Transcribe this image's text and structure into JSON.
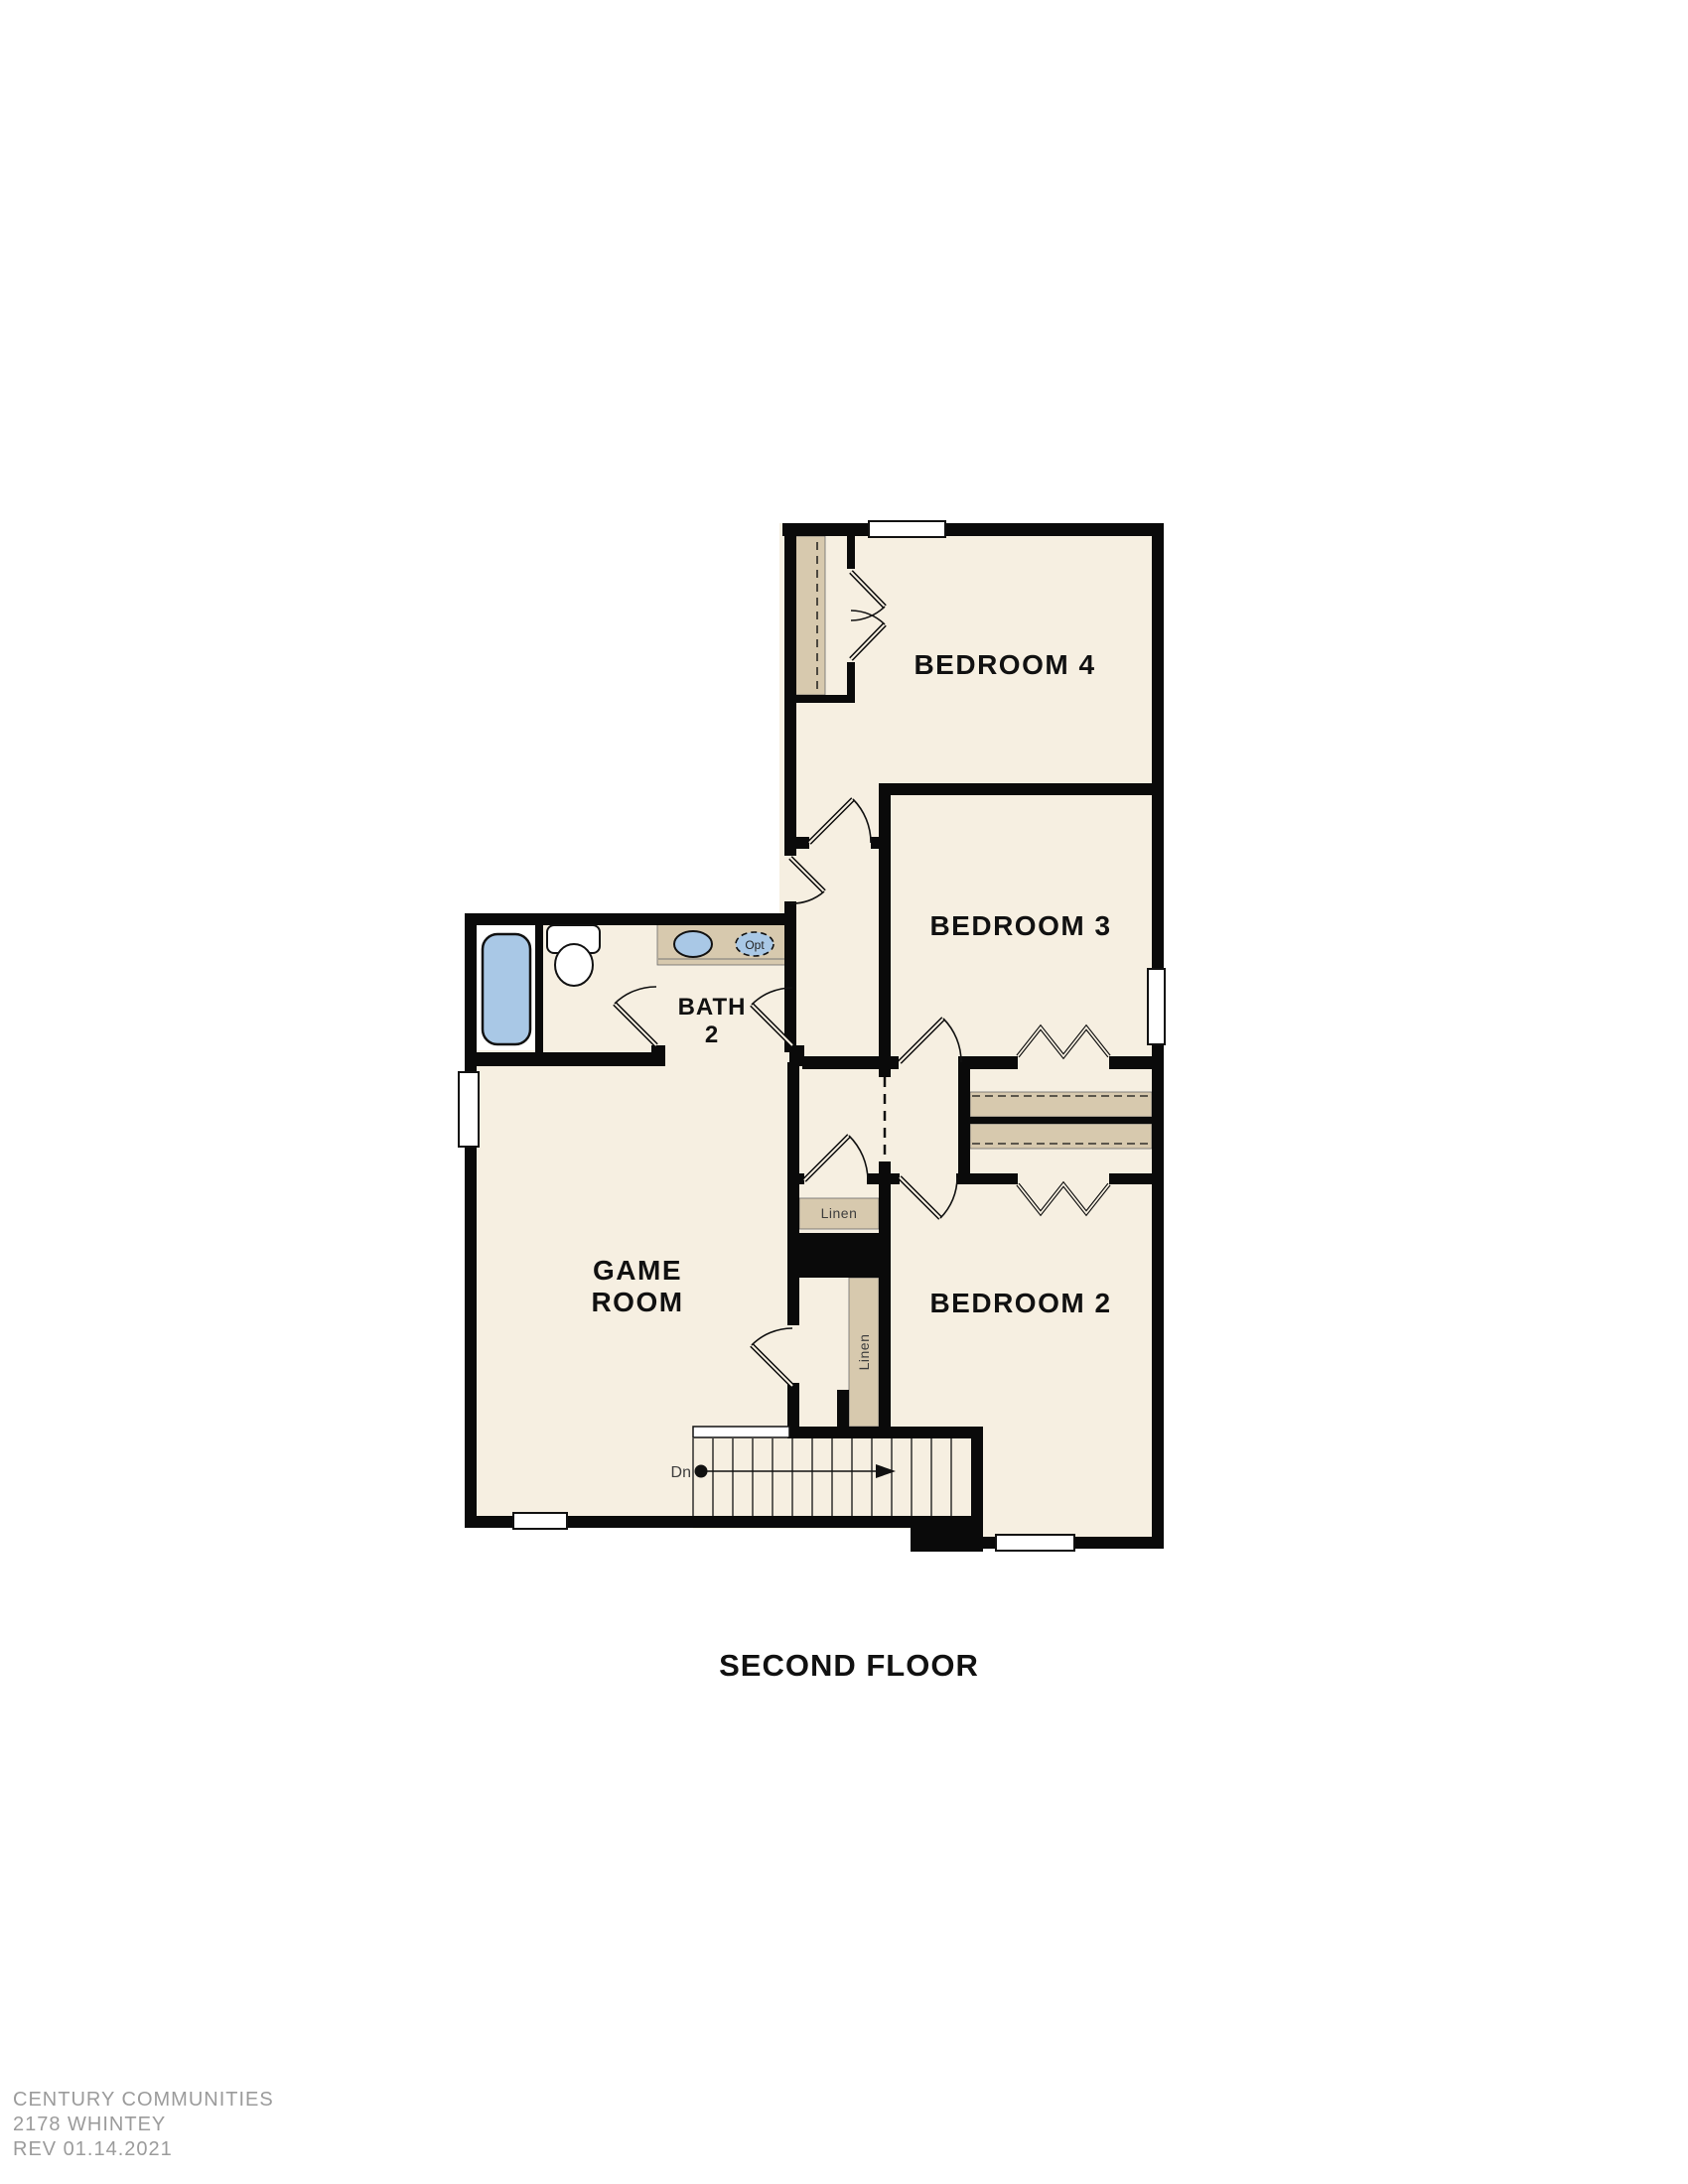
{
  "title": "SECOND FLOOR",
  "rooms": {
    "bedroom4": "BEDROOM 4",
    "bedroom3": "BEDROOM 3",
    "bedroom2": "BEDROOM 2",
    "bath2_line1": "BATH",
    "bath2_line2": "2",
    "game_line1": "GAME",
    "game_line2": "ROOM"
  },
  "closets": {
    "linen_upper": "Linen",
    "linen_lower": "Linen"
  },
  "stairs": {
    "direction_label": "Dn"
  },
  "fixtures": {
    "optional_sink_label": "Opt"
  },
  "footer": {
    "line1": "CENTURY COMMUNITIES",
    "line2": "2178 WHINTEY",
    "line3": "REV 01.14.2021"
  },
  "colors": {
    "floor": "#f6efe1",
    "closet": "#d7c9ae",
    "wall": "#0a0a0a",
    "fixture_blue": "#a9c8e6",
    "window_fill": "#ffffff",
    "label_text": "#111111",
    "secondary_text": "#3d3d3d",
    "footer_text": "#9b9b9b"
  }
}
